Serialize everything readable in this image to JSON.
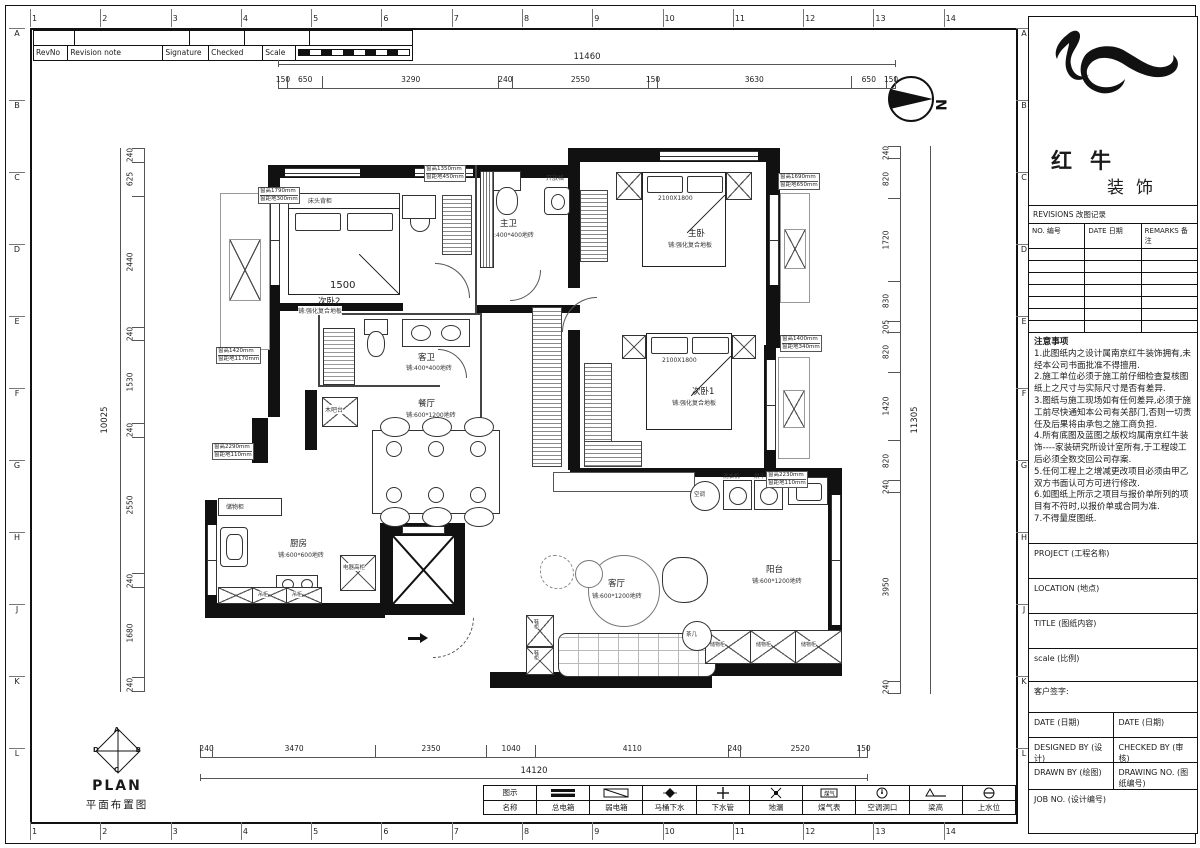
{
  "border": {
    "columns": [
      "1",
      "2",
      "3",
      "4",
      "5",
      "6",
      "7",
      "8",
      "9",
      "10",
      "11",
      "12",
      "13",
      "14"
    ],
    "rows": [
      "A",
      "B",
      "C",
      "D",
      "E",
      "F",
      "G",
      "H",
      "J",
      "K",
      "L"
    ]
  },
  "revision_strip": {
    "rev_no": "RevNo",
    "revision_note": "Revision note",
    "signature": "Signature",
    "checked": "Checked",
    "scale": "Scale"
  },
  "north_label": "N",
  "plan": {
    "rooms": [
      {
        "name": "次卧2",
        "floor": "铺:强化复合地板"
      },
      {
        "name": "主卫",
        "floor": "铺:400*400地砖"
      },
      {
        "name": "主卧",
        "floor": "铺:强化复合地板"
      },
      {
        "name": "客卫",
        "floor": "铺:400*400地砖"
      },
      {
        "name": "餐厅",
        "floor": "铺:600*1200地砖"
      },
      {
        "name": "次卧1",
        "floor": "铺:强化复合地板"
      },
      {
        "name": "厨房",
        "floor": "铺:600*600地砖"
      },
      {
        "name": "客厅",
        "floor": "铺:600*1200地砖"
      },
      {
        "name": "阳台",
        "floor": "铺:600*1200地砖"
      }
    ],
    "labels": {
      "bedside_cabinet": "床头背柜",
      "open_shelf": "开放格",
      "wood_bar": "木吧台",
      "storage_cabinet": "储物柜",
      "appliance_cabinet": "电器高柜",
      "hanging_cabinet": "吊柜",
      "shoe_cabinet": "鞋柜",
      "tea_table": "茶几",
      "ac": "空调",
      "washer": "洗衣机",
      "dryer": "烘干机",
      "bed_size": "2100X1800",
      "room_dim": "1500"
    },
    "window_tags": [
      {
        "line1": "窗高1790mm",
        "line2": "窗距地300mm"
      },
      {
        "line1": "窗高1350mm",
        "line2": "窗距地450mm"
      },
      {
        "line1": "窗高1690mm",
        "line2": "窗距地650mm"
      },
      {
        "line1": "窗高1400mm",
        "line2": "窗距地340mm"
      },
      {
        "line1": "窗高2230mm",
        "line2": "窗距地110mm"
      },
      {
        "line1": "窗高1420mm",
        "line2": "窗距地1170mm"
      },
      {
        "line1": "窗高2290mm",
        "line2": "窗距地110mm"
      }
    ]
  },
  "dims": {
    "top": {
      "total": "11460",
      "segments": [
        150,
        650,
        3290,
        240,
        2550,
        150,
        3630,
        650,
        150
      ]
    },
    "left": {
      "total": "10025",
      "segments": [
        240,
        625,
        2440,
        240,
        1530,
        240,
        2550,
        240,
        1680,
        240
      ]
    },
    "right": {
      "total": "11305",
      "segments": [
        240,
        820,
        1720,
        830,
        205,
        820,
        1420,
        820,
        240,
        3950,
        240
      ]
    },
    "bottom": {
      "total": "14120",
      "segments": [
        240,
        3470,
        2350,
        1040,
        4110,
        240,
        2520,
        150
      ]
    }
  },
  "title_block": {
    "brand_cn_1": "红牛",
    "brand_cn_2": "装饰",
    "revisions_header": "REVISIONS 改图记录",
    "revisions_cols": [
      "NO. 编号",
      "DATE 日期",
      "REMARKS 备注"
    ],
    "notes_title": "注意事项",
    "notes": [
      "1.此图纸内之设计属南京红牛装饰拥有,未经本公司书面批准不得擅用.",
      "2.施工单位必须于施工前仔细检查复核图纸上之尺寸与实际尺寸是否有差异.",
      "3.图纸与施工现场如有任何差异,必须于施工前尽快通知本公司有关部门,否则一切责任及后果将由承包之施工商负担.",
      "4.所有底图及蓝图之版权均属南京红牛装饰----家装研究所设计室所有,于工程竣工后必须全数交回公司存案.",
      "5.任何工程上之增减更改项目必须由甲乙双方书面认可方可进行修改.",
      "6.如图纸上所示之项目与报价单所列的项目有不符时,以报价单或合同为准.",
      "7.不得量度图纸."
    ],
    "project": "PROJECT (工程名称)",
    "location": "LOCATION (地点)",
    "title": "TITLE (图纸内容)",
    "scale": "scale (比例)",
    "client_sign": "客户签字:",
    "date_left": "DATE (日期)",
    "date_right": "DATE (日期)",
    "designed_by": "DESIGNED BY (设计)",
    "checked_by": "CHECKED BY (审核)",
    "drawn_by": "DRAWN BY (绘图)",
    "drawing_no": "DRAWING NO. (图纸编号)",
    "job_no": "JOB NO. (设计编号)"
  },
  "legend": {
    "icon_header": "图示",
    "name_header": "名称",
    "items": [
      {
        "icon": "main-power-box",
        "label": "总电箱"
      },
      {
        "icon": "weak-current-box",
        "label": "弱电箱"
      },
      {
        "icon": "toilet-drain",
        "label": "马桶下水"
      },
      {
        "icon": "sewer-pipe",
        "label": "下水管"
      },
      {
        "icon": "floor-drain",
        "label": "地漏"
      },
      {
        "icon": "gas-meter",
        "label": "煤气表"
      },
      {
        "icon": "ac-hole",
        "label": "空调洞口"
      },
      {
        "icon": "beam-height",
        "label": "梁高"
      },
      {
        "icon": "water-supply",
        "label": "上水位"
      }
    ]
  },
  "plan_block": {
    "diamond_letters": [
      "A",
      "D",
      "B",
      "C"
    ],
    "title": "PLAN",
    "subtitle": "平面布置图"
  }
}
